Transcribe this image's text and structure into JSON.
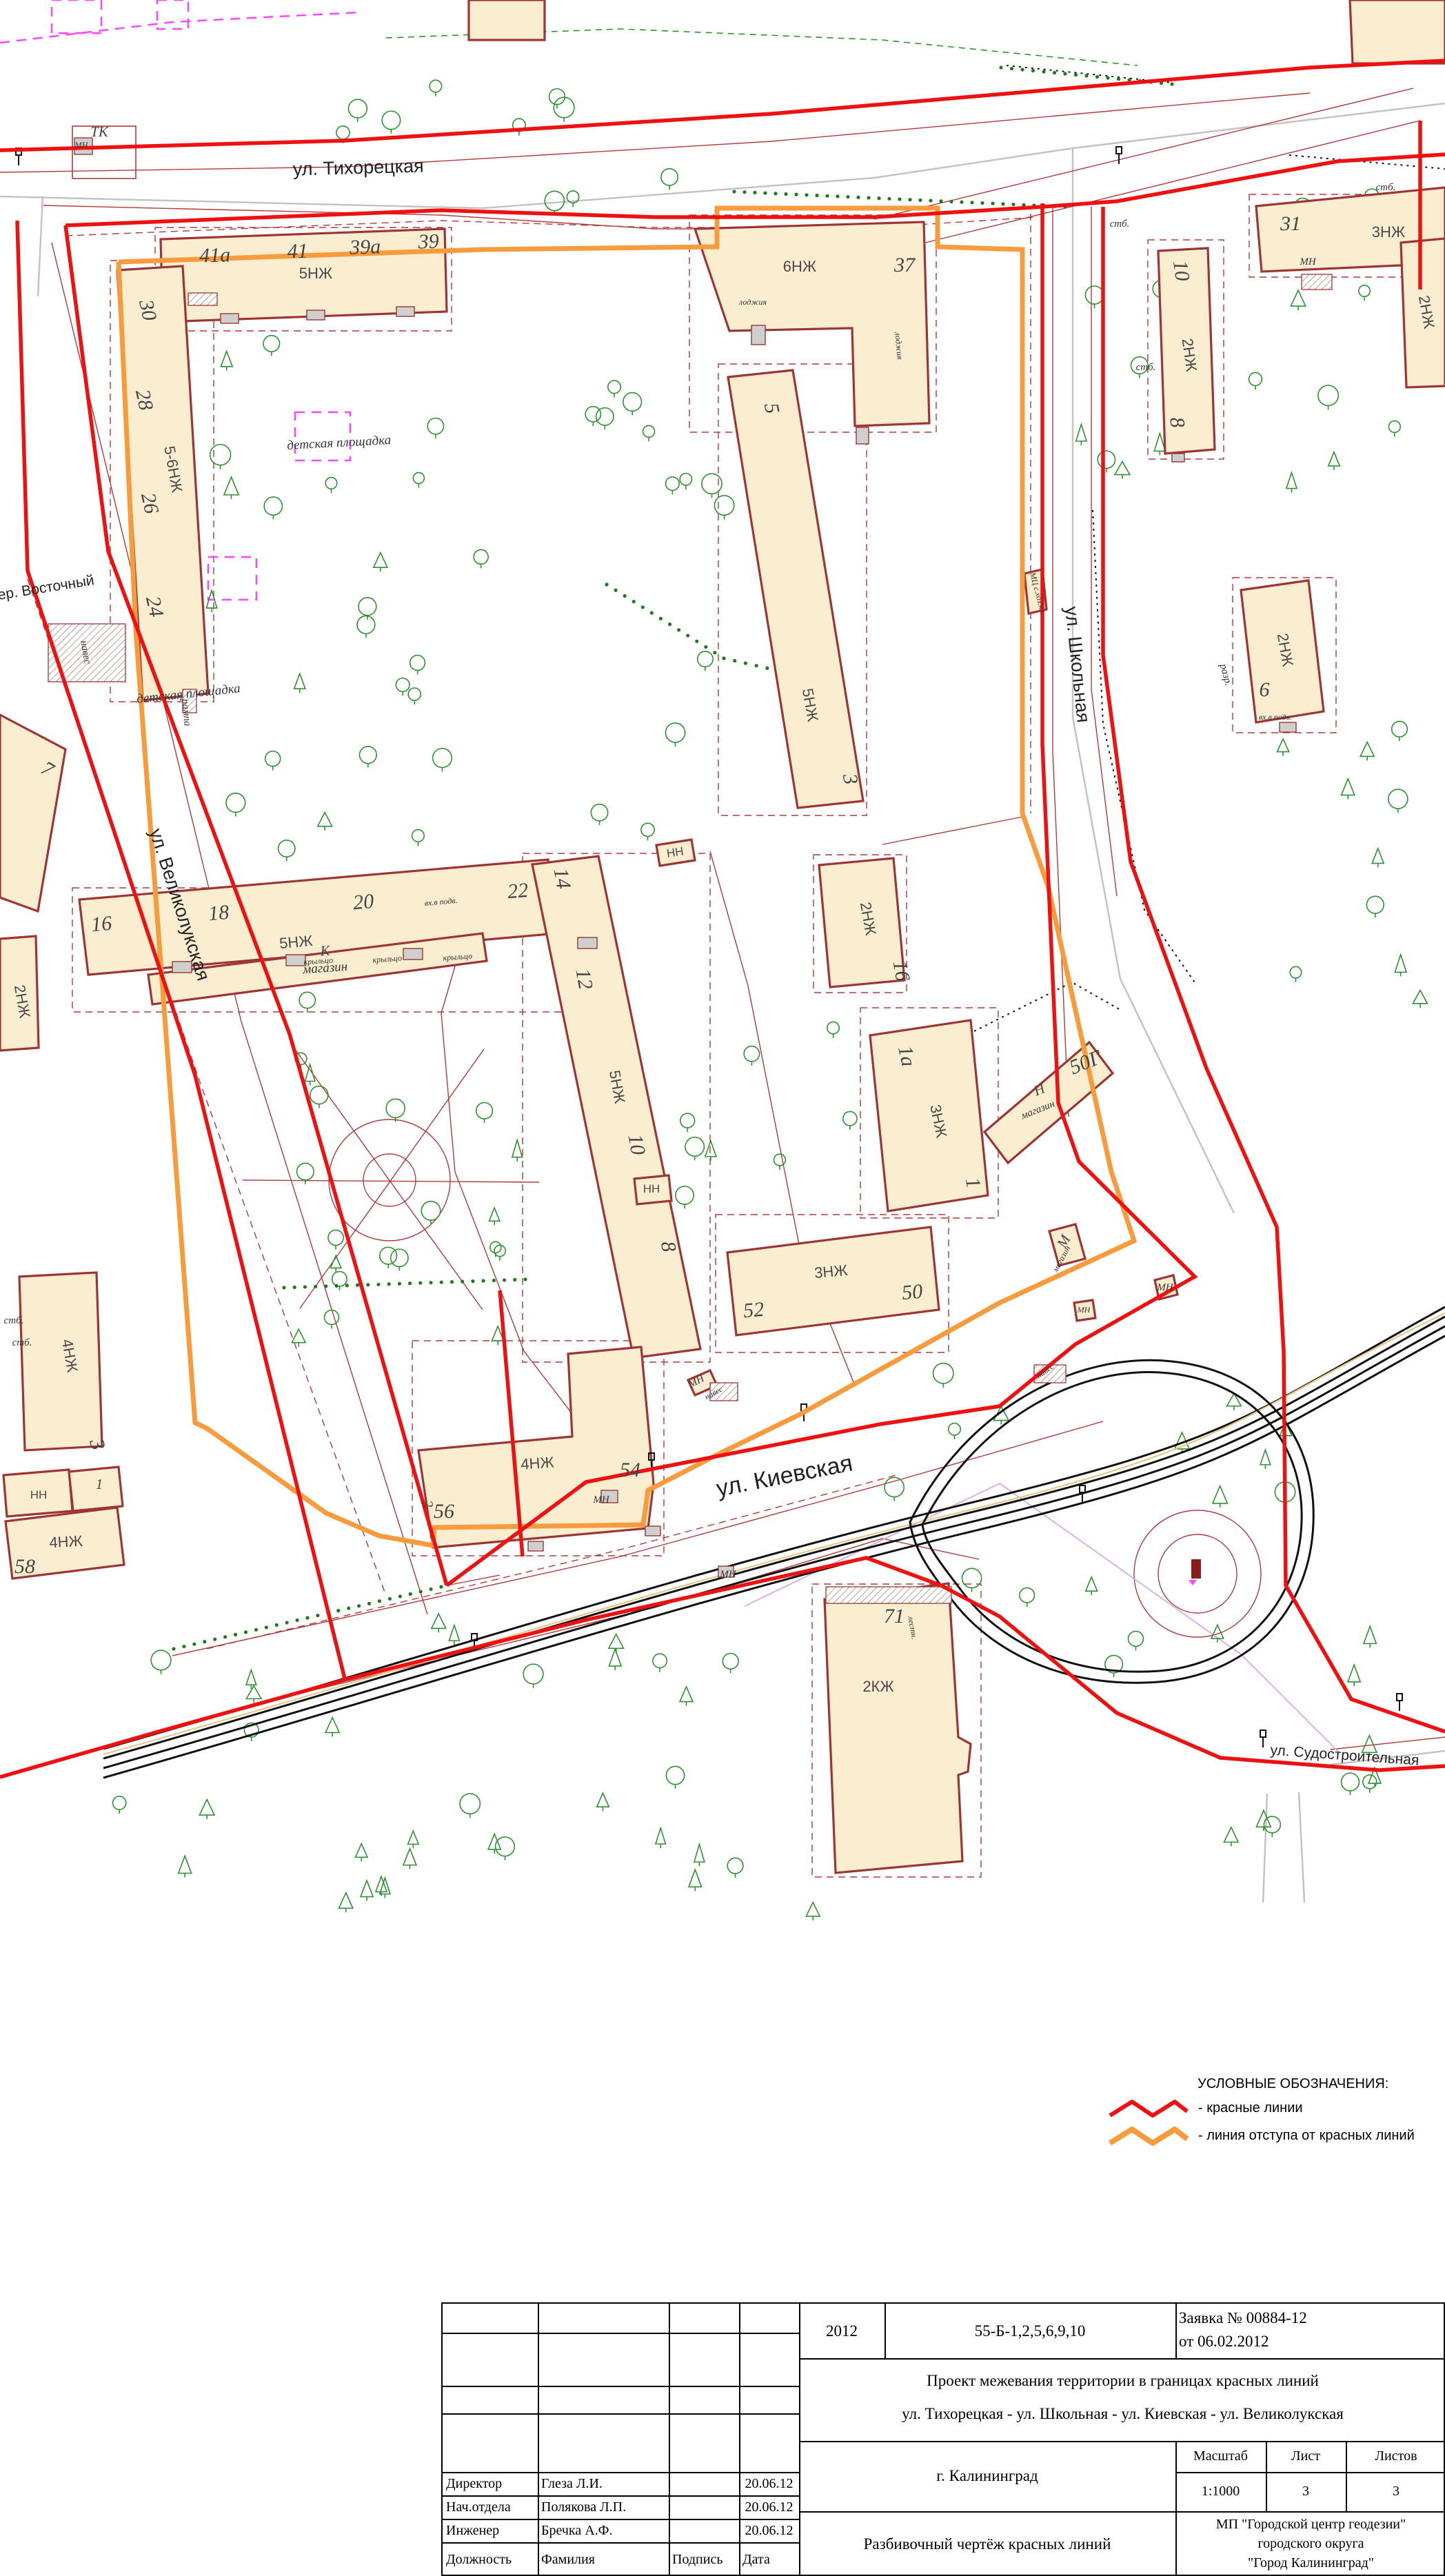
{
  "map": {
    "colors": {
      "red_line": "#ee1111",
      "setback_line": "#f89b3c",
      "building_fill": "#faedd0",
      "building_stroke": "#9e3535",
      "thin_red": "#b03a3a",
      "tree_green": "#2e9230",
      "road_grey": "#c3c3c3",
      "magenta": "#ff46ff",
      "tram_black": "#111111"
    },
    "labels": [
      "ул. Тихорецкая",
      "пер. Восточный",
      "ул. Великолукская",
      "ул. Школьная",
      "ул. Киевская",
      "ул. Судостроительная",
      "41а",
      "41",
      "39а",
      "39",
      "30",
      "28",
      "26",
      "24",
      "16",
      "18",
      "20",
      "22",
      "37",
      "5",
      "3",
      "31",
      "10",
      "8",
      "6",
      "14",
      "12",
      "10",
      "8",
      "16",
      "1а",
      "1",
      "50Г",
      "52",
      "50",
      "54",
      "56",
      "2",
      "58",
      "3",
      "1",
      "7",
      "71",
      "5НЖ",
      "5-6НЖ",
      "5НЖ",
      "6НЖ",
      "5НЖ",
      "5НЖ",
      "2НЖ",
      "3НЖ",
      "3НЖ",
      "4НЖ",
      "4НЖ",
      "4НЖ",
      "2КЖ",
      "3НЖ",
      "2НЖ",
      "2НЖ",
      "2НЖ",
      "2НЖ",
      "НН",
      "НН",
      "НН",
      "детская площадка",
      "детская площадка",
      "магазин",
      "К",
      "Н",
      "магазин",
      "М",
      "магазин",
      "ТК",
      "МН",
      "МН",
      "МН",
      "МН",
      "МН",
      "МН",
      "МН",
      "навес",
      "навес",
      "навес",
      "стб.",
      "стб.",
      "стб.",
      "стб.",
      "стб.",
      "разр.",
      "лоджия",
      "лоджия",
      "вх.в подв.",
      "вх.в подв.",
      "крыльцо",
      "крыльцо",
      "крыльцо",
      "рампа",
      "лестн.",
      "МЦ с.хоз.кл."
    ]
  },
  "legend": {
    "title": "УСЛОВНЫЕ ОБОЗНАЧЕНИЯ:",
    "items": [
      {
        "label": "- красные линии",
        "color": "#ee1111"
      },
      {
        "label": "- линия отступа от красных линий",
        "color": "#f89b3c"
      }
    ]
  },
  "title_block": {
    "year": "2012",
    "code": "55-Б-1,2,5,6,9,10",
    "request_line1": "Заявка №  00884-12",
    "request_line2": "от 06.02.2012",
    "project_line1": "Проект межевания территории в границах красных линий",
    "project_line2": "ул. Тихорецкая - ул. Школьная - ул. Киевская - ул. Великолукская",
    "city": "г. Калининград",
    "scale_label": "Масштаб",
    "scale_value": "1:1000",
    "sheet_label": "Лист",
    "sheet_value": "3",
    "sheets_label": "Листов",
    "sheets_value": "3",
    "drawing_title": "Разбивочный чертёж красных линий",
    "org_line1": "МП \"Городской центр геодезии\"",
    "org_line2": "городского округа",
    "org_line3": "\"Город Калининград\"",
    "signatures": [
      {
        "role": "Директор",
        "name": "Глеза Л.И.",
        "date": "20.06.12"
      },
      {
        "role": "Нач.отдела",
        "name": "Полякова Л.П.",
        "date": "20.06.12"
      },
      {
        "role": "Инженер",
        "name": "Бречка А.Ф.",
        "date": "20.06.12"
      }
    ],
    "footer": {
      "role": "Должность",
      "name": "Фамилия",
      "sign": "Подпись",
      "date": "Дата"
    }
  }
}
